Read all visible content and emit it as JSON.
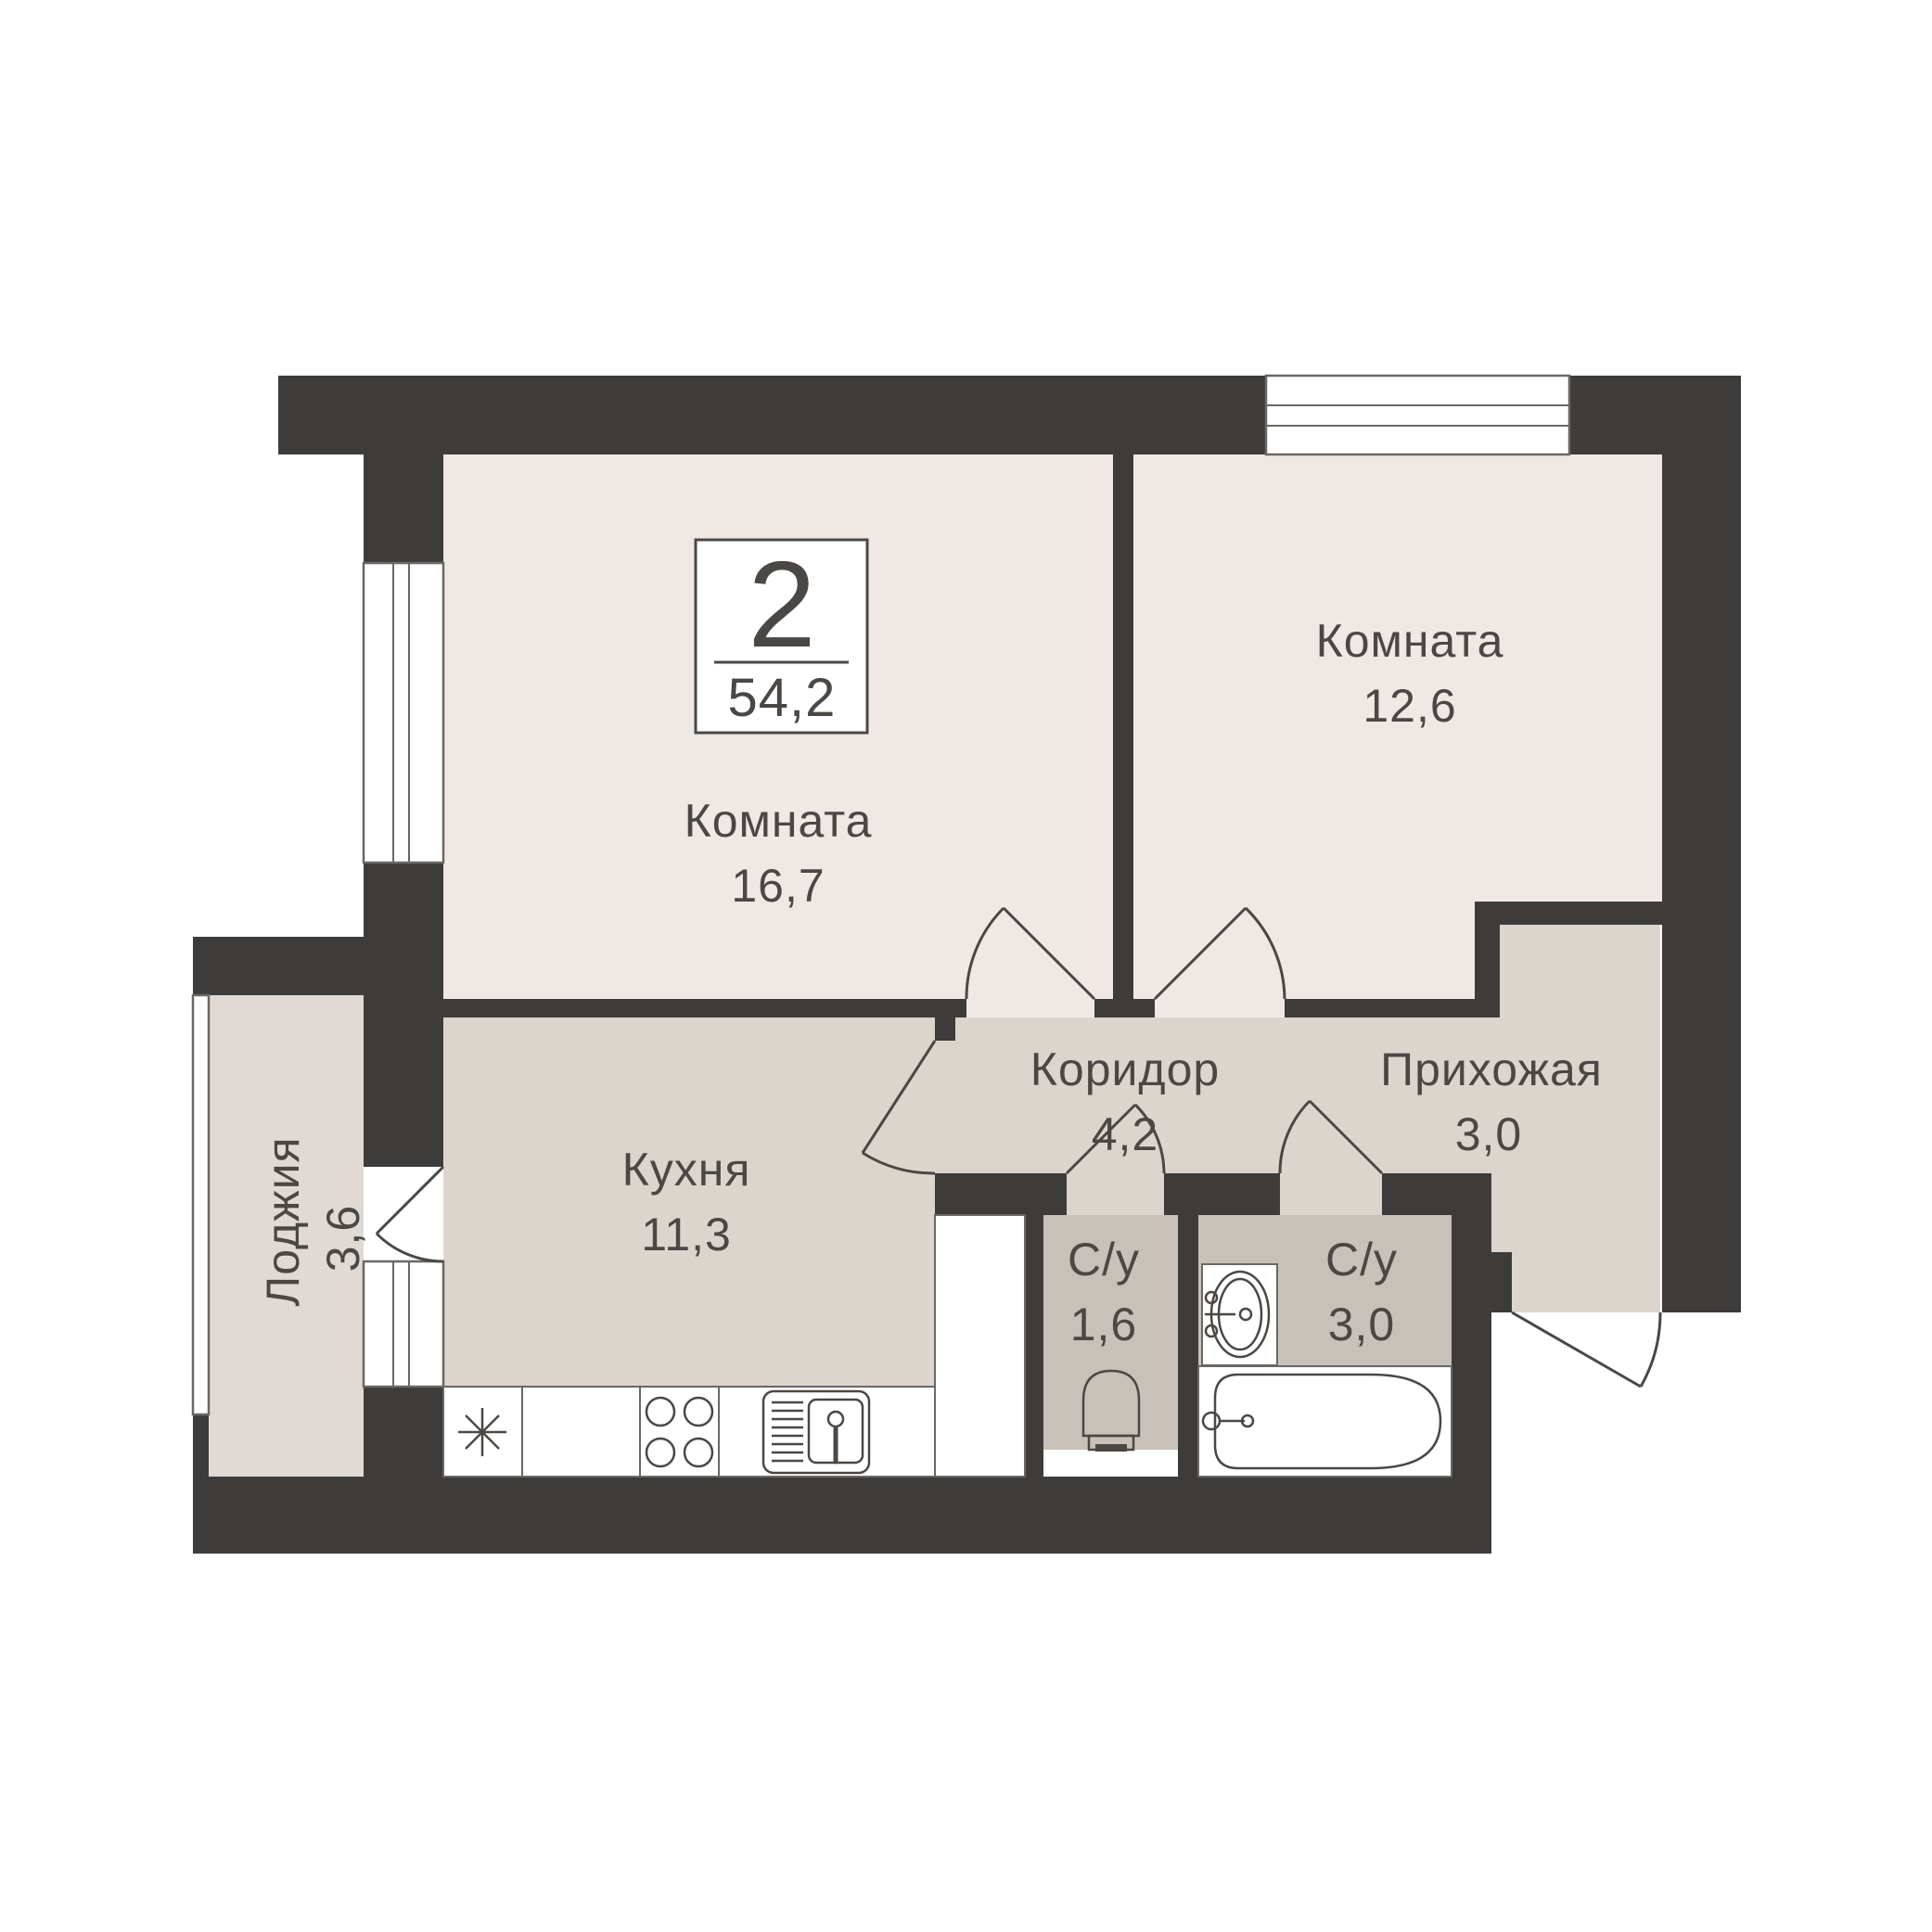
{
  "unit_card": {
    "rooms_count": "2",
    "total_area": "54,2"
  },
  "rooms": {
    "living1": {
      "label": "Комната",
      "area": "16,7"
    },
    "living2": {
      "label": "Комната",
      "area": "12,6"
    },
    "kitchen": {
      "label": "Кухня",
      "area": "11,3"
    },
    "corridor": {
      "label": "Коридор",
      "area": "4,2"
    },
    "hallway": {
      "label": "Прихожая",
      "area": "3,0"
    },
    "wc_small": {
      "label": "С/у",
      "area": "1,6"
    },
    "wc_large": {
      "label": "С/у",
      "area": "3,0"
    },
    "loggia": {
      "label": "Лоджия",
      "area": "3,6"
    }
  },
  "colors": {
    "wall": "#3E3C3A",
    "room": "#F0E8E4",
    "hall": "#DCD5CE",
    "wc": "#C8C1BA",
    "loggia": "#E1DAD4",
    "line": "#4A4744",
    "thin": "#6A6764",
    "text": "#4A4744",
    "background": "#FFFFFF"
  }
}
